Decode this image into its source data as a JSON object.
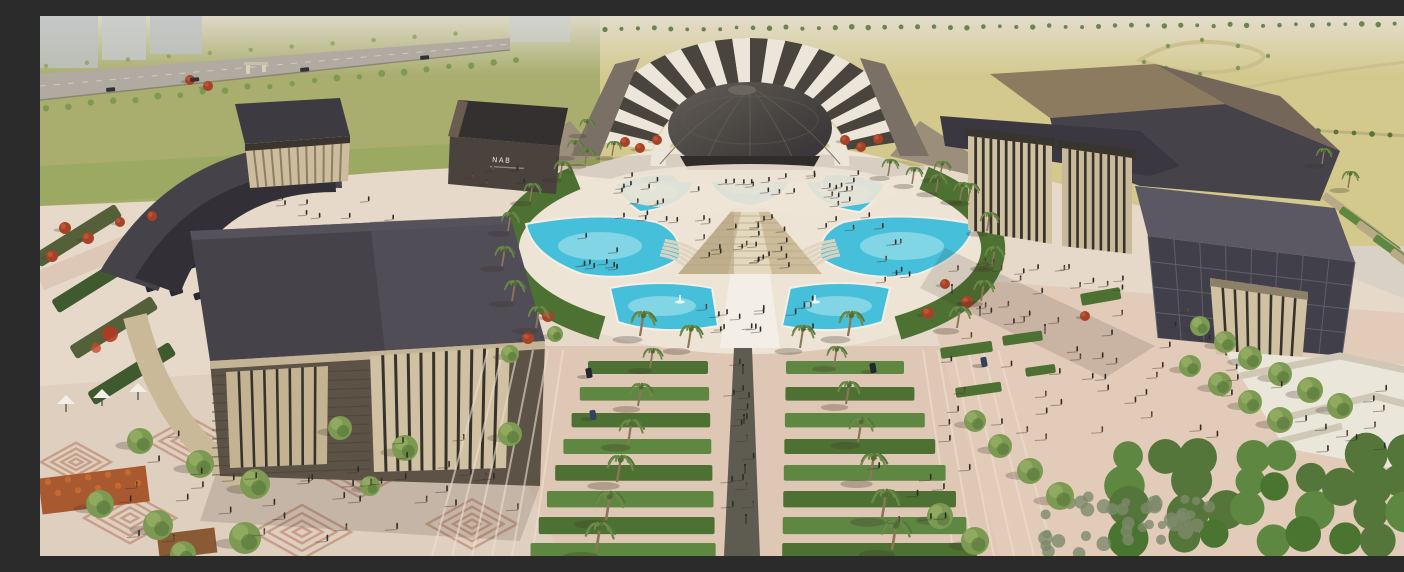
{
  "image": {
    "kind": "architectural-aerial-rendering",
    "subject": "cultural-district-campus-with-opera-dome-pyramid-fountain-plaza"
  },
  "sign": {
    "label": "NAB"
  },
  "palette": {
    "haze": "#d8d2c6",
    "city": "#bfc3c9",
    "fieldLeft": "#a9ad6e",
    "fieldRight": "#d3c98d",
    "fieldLight": "#ded5a2",
    "grassMid": "#99a75f",
    "highway": "#b1aaa0",
    "roadPale": "#cabf8c",
    "sitePink": "#ddc7b6",
    "plaza": "#e6d9ca",
    "plazaLight": "#eee4d6",
    "promenade": "#dfc7b5",
    "treeGreen": "#7d9a52",
    "treeDark": "#55763b",
    "forest": "#4a7530",
    "hedge": "#4d7132",
    "hedgeLight": "#5e8741",
    "redTree": "#a64227",
    "pool": "#46c0da",
    "poolLight": "#9adfe9",
    "poolEdge": "#f3efe6",
    "pyramid": "#cdbc9b",
    "pyramidLight": "#e4d8bf",
    "pyramidShade": "#b4a37f",
    "steps": "#ded4c0",
    "roof": "#45424a",
    "roofLight": "#5b5863",
    "roofDark": "#332f36",
    "stone": "#d0c1a3",
    "stoneDark": "#b7a98a",
    "slot": "#37322b",
    "facadeBrown": "#5c5246",
    "facadeLine": "#4a4138",
    "lattice": "#41404a",
    "latticeLine": "#5f5e6a",
    "fanLight": "#ebe6d9",
    "fanDark": "#4a443e",
    "dome": "#474340",
    "domeLight": "#635e58",
    "whiteWall": "#ebe6da",
    "wallShade": "#cfc8b6",
    "people": "#2e2c2a",
    "trunk": "#8b7757",
    "flowerOrange": "#c76b31",
    "flowerYellow": "#d9c93c",
    "planter": "#a8592f",
    "pattern": "#b26e52",
    "shadow": "#3c3226"
  },
  "scene": {
    "palms": [
      [
        520,
        162,
        0.85
      ],
      [
        490,
        185,
        0.9
      ],
      [
        468,
        215,
        0.95
      ],
      [
        462,
        250,
        1.0
      ],
      [
        472,
        285,
        1.05
      ],
      [
        496,
        312,
        1.1
      ],
      [
        900,
        162,
        0.85
      ],
      [
        928,
        185,
        0.9
      ],
      [
        947,
        215,
        0.95
      ],
      [
        952,
        250,
        1.0
      ],
      [
        941,
        285,
        1.05
      ],
      [
        917,
        312,
        1.1
      ],
      [
        545,
        148,
        0.8
      ],
      [
        572,
        140,
        0.75
      ],
      [
        848,
        160,
        0.85
      ],
      [
        872,
        168,
        0.85
      ],
      [
        896,
        176,
        0.9
      ],
      [
        920,
        184,
        0.9
      ],
      [
        600,
        320,
        1.25
      ],
      [
        648,
        332,
        1.15
      ],
      [
        760,
        332,
        1.15
      ],
      [
        808,
        320,
        1.25
      ],
      [
        610,
        352,
        1.0
      ],
      [
        598,
        390,
        1.15
      ],
      [
        588,
        428,
        1.25
      ],
      [
        577,
        466,
        1.35
      ],
      [
        566,
        504,
        1.45
      ],
      [
        556,
        536,
        1.5
      ],
      [
        794,
        350,
        1.0
      ],
      [
        806,
        388,
        1.15
      ],
      [
        818,
        426,
        1.25
      ],
      [
        830,
        464,
        1.35
      ],
      [
        842,
        502,
        1.45
      ],
      [
        852,
        534,
        1.5
      ],
      [
        1282,
        148,
        0.8
      ],
      [
        1308,
        172,
        0.85
      ],
      [
        545,
        118,
        0.75
      ],
      [
        533,
        140,
        0.8
      ]
    ],
    "trees_round": [
      [
        100,
        425,
        13
      ],
      [
        160,
        448,
        14
      ],
      [
        215,
        468,
        15
      ],
      [
        60,
        488,
        14
      ],
      [
        118,
        509,
        15
      ],
      [
        205,
        522,
        16
      ],
      [
        143,
        538,
        13
      ],
      [
        300,
        412,
        12
      ],
      [
        365,
        432,
        13
      ],
      [
        470,
        418,
        12
      ],
      [
        330,
        470,
        10
      ],
      [
        515,
        318,
        8
      ],
      [
        470,
        338,
        9
      ],
      [
        1160,
        310,
        10
      ],
      [
        1185,
        326,
        11
      ],
      [
        1210,
        342,
        12
      ],
      [
        1240,
        358,
        12
      ],
      [
        1270,
        374,
        13
      ],
      [
        1300,
        390,
        13
      ],
      [
        1150,
        350,
        11
      ],
      [
        1180,
        368,
        12
      ],
      [
        1210,
        386,
        12
      ],
      [
        1240,
        404,
        13
      ],
      [
        960,
        430,
        12
      ],
      [
        990,
        455,
        13
      ],
      [
        1020,
        480,
        14
      ],
      [
        935,
        405,
        11
      ],
      [
        900,
        500,
        13
      ],
      [
        935,
        525,
        14
      ]
    ],
    "trees_red": [
      [
        585,
        126,
        5
      ],
      [
        600,
        132,
        5
      ],
      [
        617,
        124,
        5
      ],
      [
        805,
        124,
        5
      ],
      [
        821,
        131,
        5
      ],
      [
        838,
        123,
        5
      ],
      [
        508,
        300,
        6
      ],
      [
        488,
        322,
        6
      ],
      [
        927,
        286,
        6
      ],
      [
        888,
        297,
        6
      ],
      [
        905,
        268,
        5
      ],
      [
        25,
        212,
        6
      ],
      [
        48,
        222,
        6
      ],
      [
        12,
        240,
        6
      ],
      [
        80,
        206,
        5
      ],
      [
        112,
        200,
        5
      ],
      [
        1045,
        300,
        5
      ],
      [
        150,
        64,
        5
      ],
      [
        168,
        70,
        5
      ]
    ],
    "hedge_strips": [
      [
        900,
        332,
        52,
        11,
        -8
      ],
      [
        962,
        320,
        40,
        10,
        -8
      ],
      [
        1040,
        278,
        40,
        12,
        -10
      ],
      [
        915,
        372,
        46,
        10,
        -8
      ],
      [
        985,
        352,
        30,
        9,
        -8
      ]
    ],
    "people_clusters": [
      [
        700,
        168,
        26,
        120,
        10
      ],
      [
        710,
        228,
        24,
        46,
        26
      ],
      [
        706,
        300,
        16,
        70,
        16
      ],
      [
        704,
        430,
        14,
        12,
        85
      ],
      [
        1055,
        360,
        44,
        150,
        70
      ],
      [
        250,
        472,
        28,
        190,
        55
      ],
      [
        390,
        475,
        10,
        90,
        25
      ],
      [
        1000,
        262,
        16,
        90,
        18
      ],
      [
        608,
        200,
        8,
        30,
        20
      ],
      [
        812,
        200,
        8,
        30,
        20
      ],
      [
        1265,
        395,
        12,
        85,
        40
      ],
      [
        300,
        192,
        8,
        60,
        12
      ],
      [
        460,
        160,
        6,
        40,
        10
      ],
      [
        890,
        480,
        8,
        60,
        30
      ],
      [
        560,
        250,
        8,
        18,
        40
      ],
      [
        856,
        250,
        8,
        18,
        40
      ]
    ],
    "highway_cars": [
      [
        66,
        72
      ],
      [
        150,
        62
      ],
      [
        260,
        52
      ],
      [
        380,
        40
      ]
    ],
    "site_cars": [
      [
        549,
        357
      ],
      [
        553,
        399
      ],
      [
        833,
        352
      ],
      [
        944,
        346
      ]
    ],
    "parking": {
      "rows": 2,
      "per_row": 6,
      "x": 95,
      "y": 240
    },
    "fountains": [
      [
        612,
        172
      ],
      [
        710,
        166
      ],
      [
        782,
        174
      ],
      [
        640,
        286
      ],
      [
        775,
        286
      ]
    ],
    "canopies": [
      [
        26,
        384
      ],
      [
        62,
        378
      ],
      [
        98,
        372
      ]
    ],
    "poles": [
      [
        703,
        358
      ],
      [
        704,
        408
      ],
      [
        705,
        458
      ],
      [
        706,
        508
      ],
      [
        940,
        300
      ],
      [
        1005,
        318
      ],
      [
        912,
        278
      ]
    ],
    "pattern_motifs": [
      [
        150,
        425,
        86
      ],
      [
        320,
        455,
        96
      ],
      [
        90,
        502,
        92
      ],
      [
        262,
        516,
        98
      ],
      [
        432,
        508,
        90
      ],
      [
        36,
        446,
        70
      ]
    ]
  }
}
